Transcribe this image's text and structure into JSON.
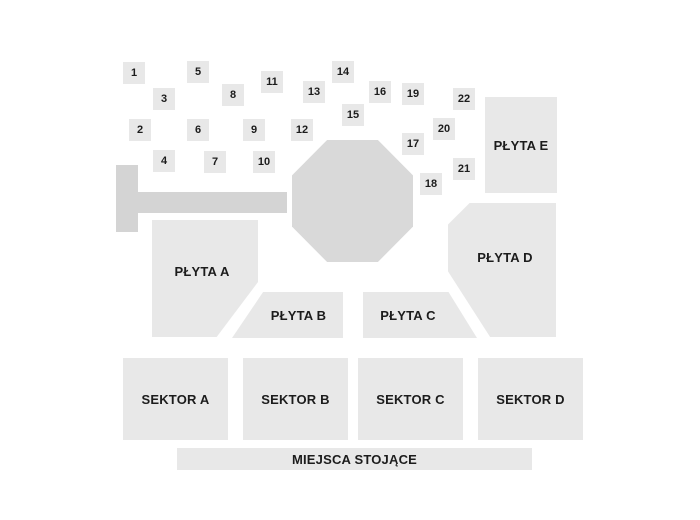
{
  "map": {
    "width": 700,
    "height": 520,
    "colors": {
      "background": "#ffffff",
      "section_fill": "#e8e8e8",
      "seat_fill": "#e8e8e8",
      "stage_fill": "#d9d9d9",
      "runway_fill": "#d4d4d4",
      "label_text": "#1c1c1c"
    },
    "stage": {
      "name": "stage-octagon",
      "x": 292,
      "y": 140,
      "w": 121,
      "h": 122
    },
    "runway": {
      "vertical_bar": {
        "x": 116,
        "y": 165,
        "w": 22,
        "h": 67
      },
      "horizontal_bar": {
        "x": 138,
        "y": 192,
        "w": 149,
        "h": 21
      }
    },
    "sections": [
      {
        "id": "plyta-a",
        "label": "PŁYTA A",
        "x": 152,
        "y": 220,
        "w": 106,
        "h": 117,
        "shape": "polygon(0% 0%, 100% 0%, 100% 53%, 61% 100%, 0% 100%)"
      },
      {
        "id": "plyta-b",
        "label": "PŁYTA B",
        "x": 232,
        "y": 292,
        "w": 111,
        "h": 46,
        "shape": "polygon(28% 0%, 100% 0%, 100% 100%, 0% 100%)"
      },
      {
        "id": "plyta-c",
        "label": "PŁYTA C",
        "x": 363,
        "y": 292,
        "w": 114,
        "h": 46,
        "shape": "polygon(0% 0%, 75% 0%, 100% 100%, 0% 100%)"
      },
      {
        "id": "plyta-d",
        "label": "PŁYTA D",
        "x": 448,
        "y": 203,
        "w": 108,
        "h": 134,
        "shape": "polygon(20% 0%, 100% 0%, 100% 100%, 39% 100%, 0% 51%, 0% 16%)"
      },
      {
        "id": "plyta-e",
        "label": "PŁYTA E",
        "x": 485,
        "y": 97,
        "w": 72,
        "h": 96,
        "shape": ""
      },
      {
        "id": "sektor-a",
        "label": "SEKTOR A",
        "x": 123,
        "y": 358,
        "w": 105,
        "h": 82,
        "shape": ""
      },
      {
        "id": "sektor-b",
        "label": "SEKTOR B",
        "x": 243,
        "y": 358,
        "w": 105,
        "h": 82,
        "shape": ""
      },
      {
        "id": "sektor-c",
        "label": "SEKTOR C",
        "x": 358,
        "y": 358,
        "w": 105,
        "h": 82,
        "shape": ""
      },
      {
        "id": "sektor-d",
        "label": "SEKTOR D",
        "x": 478,
        "y": 358,
        "w": 105,
        "h": 82,
        "shape": ""
      },
      {
        "id": "miejsca-stojace",
        "label": "MIEJSCA STOJĄCE",
        "x": 177,
        "y": 448,
        "w": 355,
        "h": 22,
        "shape": ""
      }
    ],
    "seat_boxes": [
      {
        "label": "1",
        "x": 123,
        "y": 62
      },
      {
        "label": "2",
        "x": 129,
        "y": 119
      },
      {
        "label": "3",
        "x": 153,
        "y": 88
      },
      {
        "label": "4",
        "x": 153,
        "y": 150
      },
      {
        "label": "5",
        "x": 187,
        "y": 61
      },
      {
        "label": "6",
        "x": 187,
        "y": 119
      },
      {
        "label": "7",
        "x": 204,
        "y": 151
      },
      {
        "label": "8",
        "x": 222,
        "y": 84
      },
      {
        "label": "9",
        "x": 243,
        "y": 119
      },
      {
        "label": "10",
        "x": 253,
        "y": 151
      },
      {
        "label": "11",
        "x": 261,
        "y": 71
      },
      {
        "label": "12",
        "x": 291,
        "y": 119
      },
      {
        "label": "13",
        "x": 303,
        "y": 81
      },
      {
        "label": "14",
        "x": 332,
        "y": 61
      },
      {
        "label": "15",
        "x": 342,
        "y": 104
      },
      {
        "label": "16",
        "x": 369,
        "y": 81
      },
      {
        "label": "17",
        "x": 402,
        "y": 133
      },
      {
        "label": "18",
        "x": 420,
        "y": 173
      },
      {
        "label": "19",
        "x": 402,
        "y": 83
      },
      {
        "label": "20",
        "x": 433,
        "y": 118
      },
      {
        "label": "21",
        "x": 453,
        "y": 158
      },
      {
        "label": "22",
        "x": 453,
        "y": 88
      }
    ]
  }
}
